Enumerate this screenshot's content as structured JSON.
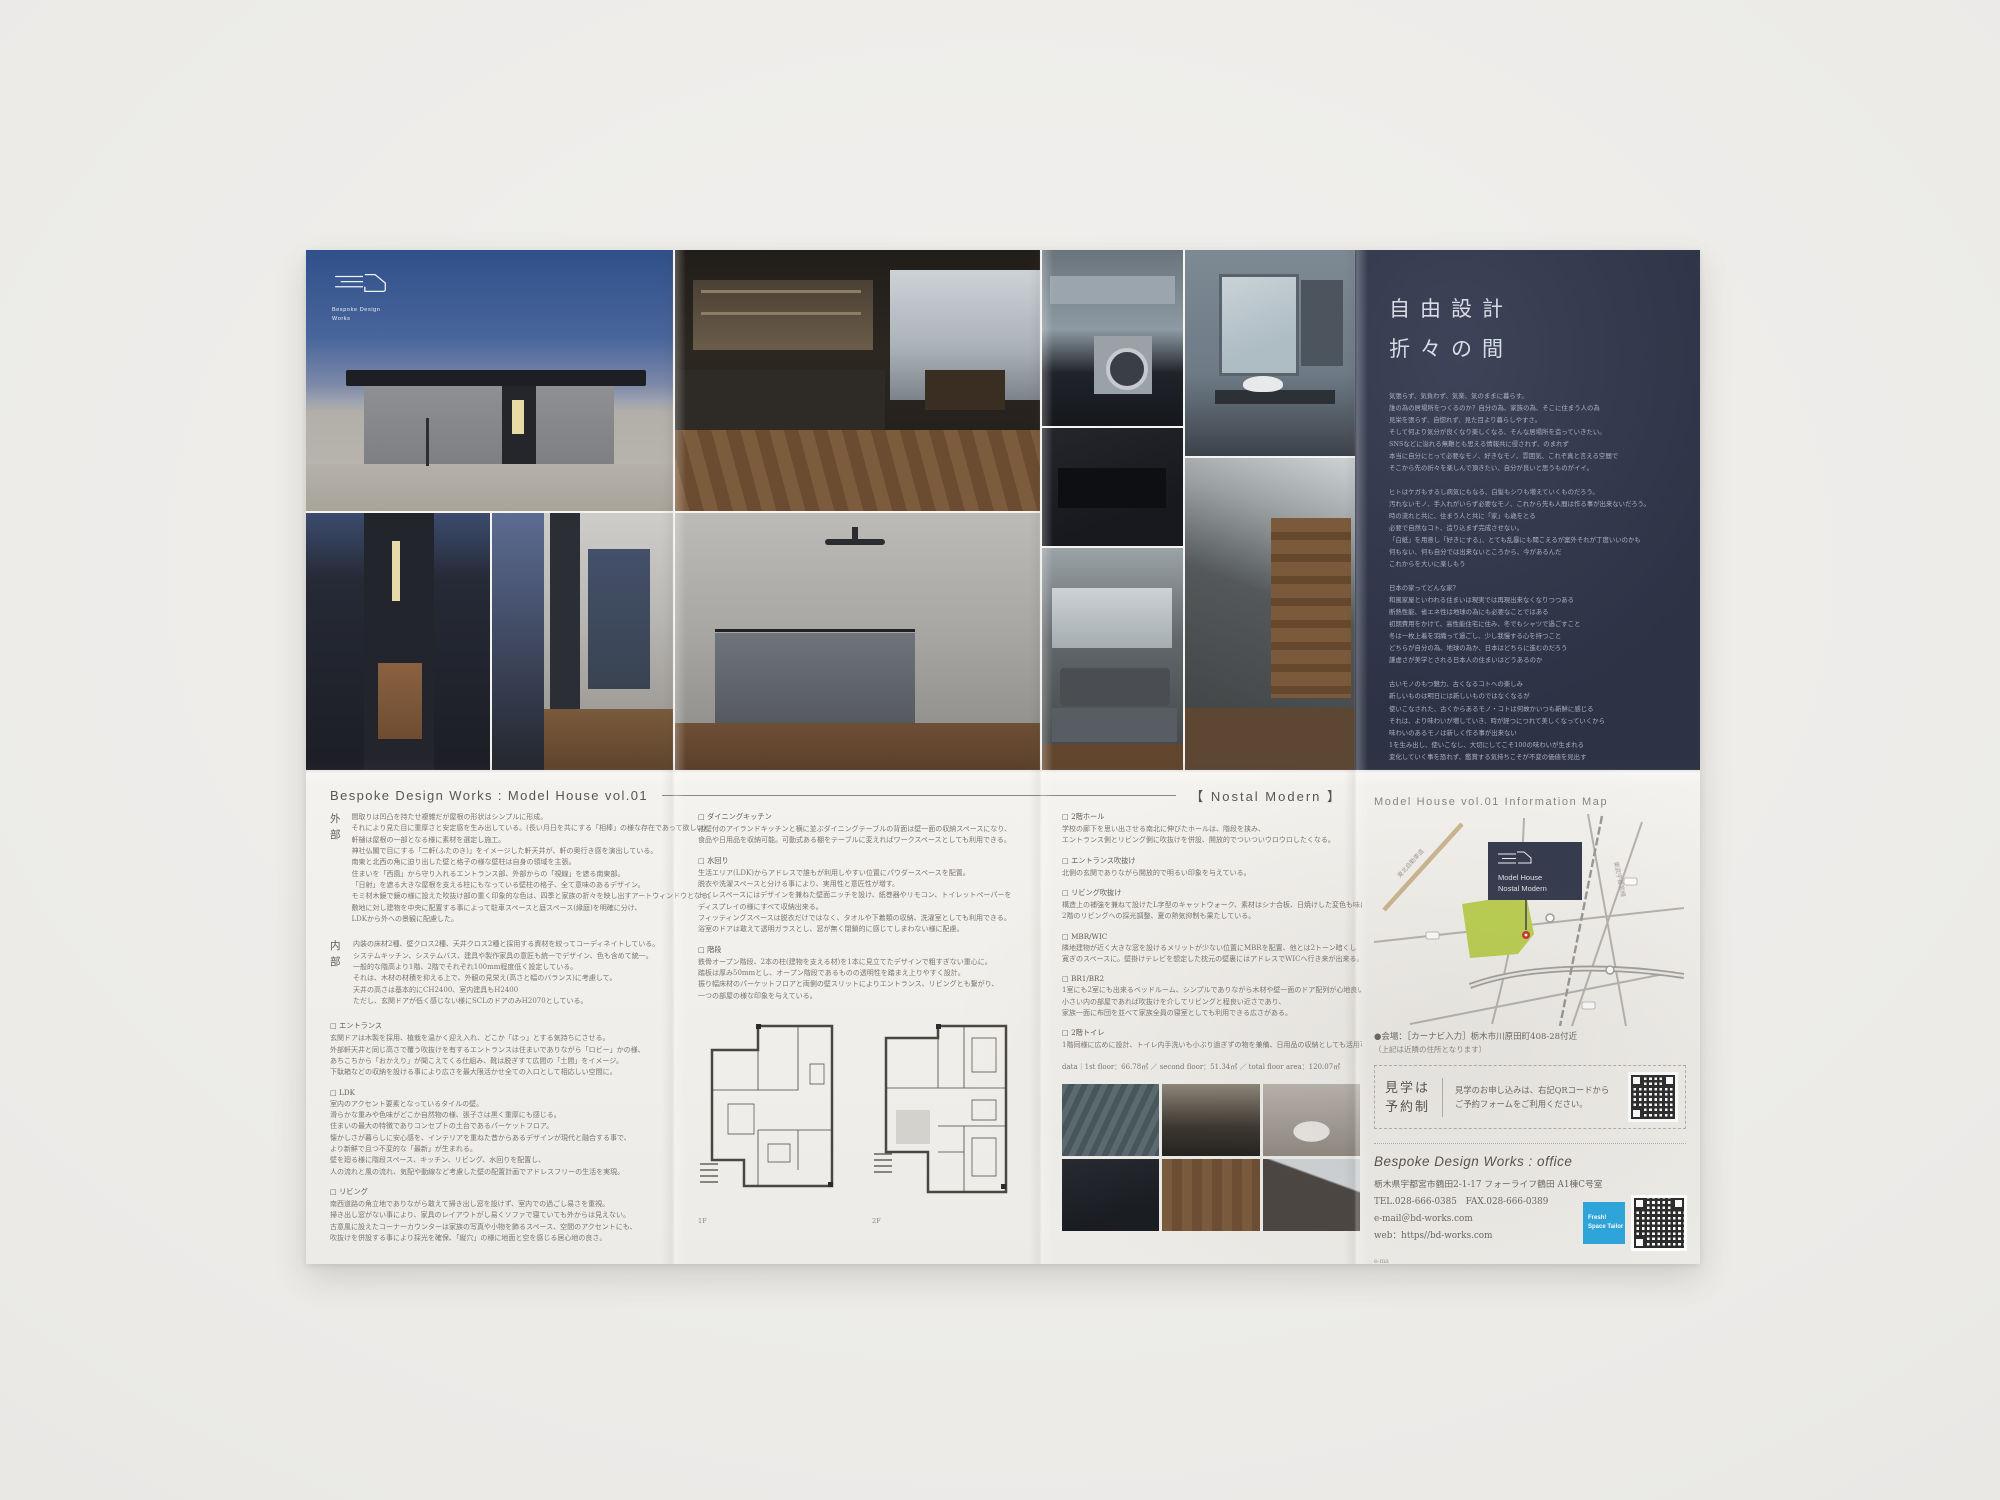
{
  "brand": {
    "logo_line1": "Bespoke Design",
    "logo_line2": "Works"
  },
  "concept": {
    "title1": "自由設計",
    "title2": "折々の間",
    "p1": [
      "気張らず、気負わず、気楽、気のままに暮らす。",
      "誰の為の居場所をつくるのか？自分の為、家族の為、そこに住まう人の為",
      "見栄を張らず、自惚れず、見た目より暮らしやすさ。",
      "そして何より気分が良くなり楽しくなる、そんな居場所を造っていきたい。",
      "SNSなどに溢れる無難とも思える情報共に侵されず、のまれず",
      "本当に自分にとって必要なモノ、好きなモノ、雰囲気、これぞ真と言える空間で",
      "そこから先の折々を楽しんで頂きたい、自分が良いと思うものがイイ。"
    ],
    "p2": [
      "ヒトはケガもするし病気にもなる、白髪もシワも増えていくものだろう。",
      "汚れないモノ、手入れがいらず必要なモノ、これから先も人間は作る事が出来ないだろう。",
      "時の流れと共に、住まう人と共に「家」も歳をとる",
      "必要で自然なコト、造り込まず完成させない。",
      "「白紙」を用意し「好きにする」、とても乱暴にも聞こえるが案外それが丁度いいのかも",
      "何もない、何も自分では出来ないところから、今があるんだ",
      "これからを大いに楽しもう"
    ],
    "p3": [
      "日本の家ってどんな家？",
      "和風家屋といわれる住まいは現実では再現出来なくなりつつある",
      "断熱性能、省エネ性は地球の為にも必要なことではある",
      "初期費用をかけて、高性能住宅に住み、冬でもシャツで過ごすこと",
      "冬は一枚上着を羽織って過ごし、少し我慢する心を持つこと",
      "どちらが自分の為、地球の為か、日本はどちらに進むのだろう",
      "謙虚さが美学とされる日本人の住まいはどうあるのか"
    ],
    "p4": [
      "古いモノのもつ魅力、古くなるコトへの楽しみ",
      "新しいものは明日には新しいものではなくなるが",
      "使いこなされた、古くからあるモノ・コトは何故かいつも新鮮に感じる",
      "それは、より味わいが増していき、時が経つにつれて美しくなっていくから",
      "味わいのあるモノは新しく作る事が出来ない",
      "1を生み出し、使いこなし、大切にしてこそ100の味わいが生まれる",
      "変化していく事を恐れず、鑑賞する気持ちこそが不変の価値を見出す"
    ],
    "signature": "Bespoke Design Works"
  },
  "works_header": {
    "title": "Bespoke Design Works : Model House vol.01",
    "tagline": "【 Nostal Modern 】"
  },
  "col1": {
    "sections": [
      {
        "label": "外部",
        "lines": [
          "間取りは凹凸を持たせ複雑だが屋根の形状はシンプルに形成。",
          "それにより見た目に重厚さと安定感を生み出している。(長い月日を共にする「相棒」の様な存在であって欲しい)",
          "軒樋は屋根の一部となる様に素材を選定し施工。",
          "神社仏閣で目にする「二軒(ふたのき)」をイメージした軒天井が、軒の奥行き感を演出している。",
          "南東と北西の角に迫り出した壁と格子の様な壁柱は自身の領域を主張。",
          "住まいを「西風」から守り入れるエントランス部、外部からの「視線」を遮る南東部。",
          "「日射」を遮る大きな屋根を支える柱にもなっている壁柱の格子、全て意味のあるデザイン。",
          "モミ材木鏡で鏡の様に設えた吹抜け部の重く印象的な色は、四季と家族の折々を映し出すアートウィンドウとなる。",
          "敷地に対し建物を中央に配置する事によって駐車スペースと庭スペース(縁庭)を明確に分け、",
          "LDKから外への景観に配慮した。"
        ]
      },
      {
        "label": "内部",
        "lines": [
          "内装の床材2種、壁クロス2種、天井クロス2種と採用する資材を絞ってコーディネイトしている。",
          "システムキッチン、システムバス、建具や製作家具の意匠も統一でデザイン、色も含めて統一。",
          "一般的な階高より1階、2階でそれぞれ100mm程度低く設定している。",
          "それは、木材の材積を抑える上で、外観の見栄え(高さと幅のバランス)に考慮して。",
          "天井の高さは基本的にCH2400、室内建具もH2400",
          "ただし、玄関ドアが低く感じない様にSCLのドアのみH2070としている。"
        ]
      }
    ],
    "subsections": [
      {
        "label": "□ エントランス",
        "lines": [
          "玄関ドアは木製を採用、植栽を温かく迎え入れ、どこか「ほっ」とする気持ちにさせる。",
          "外部軒天井と同じ高さで覆う吹抜けを有するエントランスは住まいでありながら「ロビー」かの様、",
          "あちこちから「おかえり」が聞こえてくる仕組み、靴は脱ぎすて広間の「土間」をイメージ。",
          "下駄箱などの収納を設ける事により広さを最大限活かせ全ての入口として相応しい空間に。"
        ]
      },
      {
        "label": "□ LDK",
        "lines": [
          "室内のアクセント要素となっているタイルの壁。",
          "滑らかな重みや色味がどこか自然物の様、張子さは黒く重厚にも感じる。",
          "住まいの最大の特徴でありコンセプトの土台であるパーケットフロア。",
          "懐かしさが暮らしに安心感を、インテリアを重ねた昔からあるデザインが現代と融合する事で、",
          "より新鮮で且つ不変的な「最新」が生まれる。",
          "壁を廻る様に階段スペース、キッチン、リビング、水回りを配置し、",
          "人の流れと風の流れ、気配や動線など考慮した壁の配置計画でアドレスフリーの生活を実現。"
        ]
      },
      {
        "label": "□ リビング",
        "lines": [
          "南西道路の角立地でありながら敢えて掃き出し窓を設けず、室内での過ごし易さを重視。",
          "掃き出し窓がない事により、家具のレイアウトがし易くソファで寝ていても外からは見えない。",
          "古意風に設えたコーナーカウンターは家族の写真や小物を飾るスペース、空間のアクセントにも、",
          "吹抜けを併設する事により採光を確保、「縦穴」の様に地面と空を感じる居心地の良さ。"
        ]
      }
    ]
  },
  "col2": {
    "subsections": [
      {
        "label": "□ ダイニングキッチン",
        "lines": [
          "袖壁付のアイランドキッチンと横に並ぶダイニングテーブルの背面は壁一面の収納スペースになり、",
          "食品や日用品を収納可能。可動式ある棚をテーブルに変えればワークスペースとしても利用できる。"
        ]
      },
      {
        "label": "□ 水回り",
        "lines": [
          "生活エリア(LDK)からアドレスで誰もが利用しやすい位置にパウダースペースを配置。",
          "脱衣や洗濯スペースと分ける事により、実用性と意匠性が増す。",
          "トイレスペースにはデザインを兼ねた壁面ニッチを設け、紙巻器やリモコン、トイレットペーパーを",
          "ディスプレイの様にすべて収納出来る。",
          "フィッティングスペースは脱衣だけではなく、タオルや下着類の収納、洗濯室としても利用できる。",
          "浴室のドアは敢えて透明ガラスとし、窓が無く閉鎖的に感じてしまわない様に配慮。"
        ]
      },
      {
        "label": "□ 階段",
        "lines": [
          "鉄骨オープン階段、2本の柱(建物を支える材)を1本に見立てたデザインで粗すぎない重心に。",
          "踏板は厚み50mmとし、オープン階段であるものの透明性を踏まえ上りやすく設計。",
          "振り幅床材のパーケットフロアと両側の壁スリットによりエントランス、リビングとも繋がり、",
          "一つの部屋の様な印象を与えている。"
        ]
      }
    ],
    "plans": {
      "label1": "1F",
      "label2": "2F"
    }
  },
  "col3": {
    "subsections": [
      {
        "label": "□ 2階ホール",
        "lines": [
          "学校の廊下を思い出させる南北に伸びたホールは、階段を挟み、",
          "エントランス側とリビング側に吹抜けを併設、開放的でついついウロウロしたくなる。"
        ]
      },
      {
        "label": "□ エントランス吹抜け",
        "lines": [
          "北側の玄関でありながら開放的で明るい印象を与えている。"
        ]
      },
      {
        "label": "□ リビング吹抜け",
        "lines": [
          "構造上の補強を兼ねて設けたL字型のキャットウォーク、素材はシナ合板、日焼けした変色も味に、",
          "2階のリビングへの採光調整、夏の熱気抑制も果たしている。"
        ]
      },
      {
        "label": "□ MBR/WIC",
        "lines": [
          "隣地建物が近く大きな窓を設けるメリットが少ない位置にMBRを配置、他とは2トーン暗くし",
          "寛ぎのスペースに。壁掛けテレビを想定した枕元の壁裏にはアドレスでWICへ行き来が出来る。"
        ]
      },
      {
        "label": "□ BR1/BR2",
        "lines": [
          "1室にも2室にも出来るベッドルーム、シンプルでありながら木材や壁一面のドア配列が心地良い印象、",
          "小さい内の部屋であれば吹抜けを介してリビングと程良い近さであり、",
          "家族一面に布団を並べて家族全員の寝室としても利用できる広さがある。"
        ]
      },
      {
        "label": "□ 2階トイレ",
        "lines": [
          "1階同様に広めに設計、トイレ内手洗いも小ぶり過ぎずの物を兼備、日用品の収納としても活用可能。"
        ]
      }
    ],
    "data_line": "data｜1st floor：66.78㎡ ／ second floor：51.34㎡ ／ total floor area：120.07㎡"
  },
  "info": {
    "map_title": "Model House vol.01  Information Map",
    "map": {
      "callout1": "Model House",
      "callout2": "Nostal Modern",
      "road1": "東北自動車道",
      "rail1": "東武宇都宮線"
    },
    "venue1": "●会場：［カーナビ入力］栃木市川原田町408-28付近",
    "venue2": "（上記は近隣の住所となります）",
    "reserve": {
      "badge1": "見学は",
      "badge2": "予約制",
      "line1": "見学のお申し込みは、右記QRコードから",
      "line2": "ご予約フォームをご利用ください。"
    },
    "office": {
      "title": "Bespoke Design Works : office",
      "address": "栃木県宇都宮市鶴田2-1-17 フォーライフ鶴田 A1棟C号室",
      "telfax": "TEL.028-666-0385　FAX.028-666-0389",
      "email": "e-mail＠bd-works.com",
      "web": "web：https//bd-works.com",
      "badge1": "Fresh!",
      "badge2": "Space Tailor",
      "fineprint": "e-ma"
    }
  },
  "colors": {
    "navy": "#343a4d",
    "map_green": "#bcd051",
    "pin_red": "#c9372a",
    "badge_blue": "#2ca6dd"
  }
}
